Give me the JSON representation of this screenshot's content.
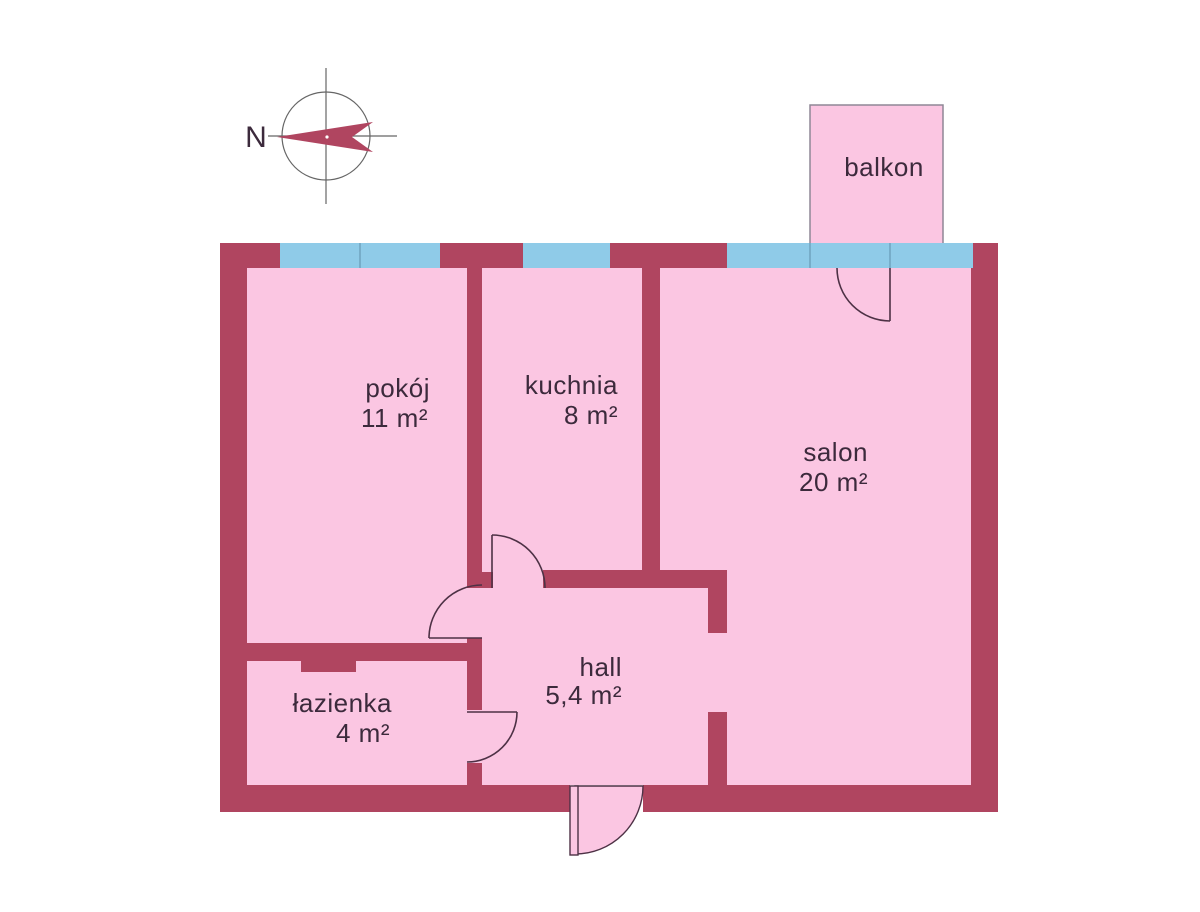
{
  "colors": {
    "background": "#ffffff",
    "wall": "#b04560",
    "room_fill": "#fbc6e2",
    "window_fill": "#8fcbe8",
    "mullion": "#6fa3bf",
    "outline": "#4d3145",
    "label_text": "#3c2a3c",
    "compass_line": "#666666",
    "balcony_outline": "#8f8796"
  },
  "compass": {
    "north_label": "N"
  },
  "rooms": {
    "balkon": {
      "name": "balkon"
    },
    "pokoj": {
      "name": "pokój",
      "area": "11 m²"
    },
    "kuchnia": {
      "name": "kuchnia",
      "area": "8 m²"
    },
    "salon": {
      "name": "salon",
      "area": "20 m²"
    },
    "lazienka": {
      "name": "łazienka",
      "area": "4 m²"
    },
    "hall": {
      "name": "hall",
      "area": "5,4 m²"
    }
  }
}
